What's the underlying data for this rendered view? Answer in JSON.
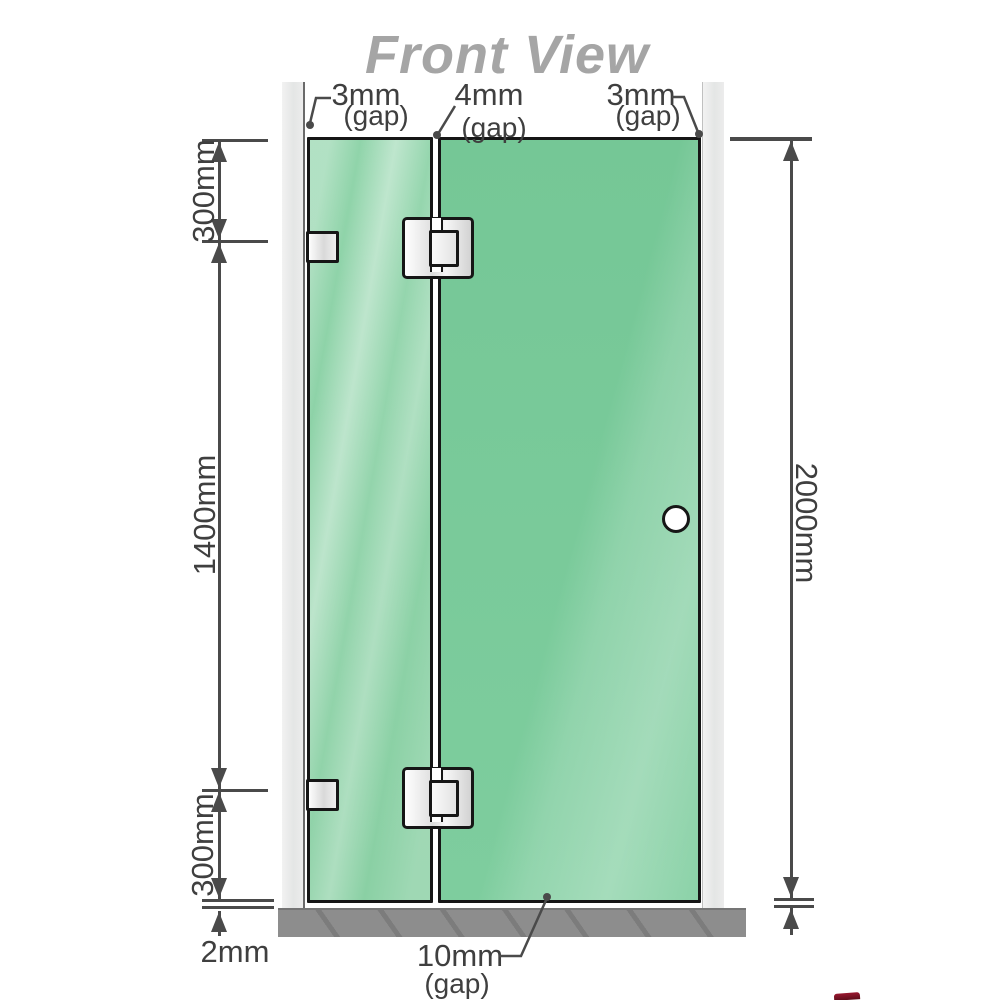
{
  "title": "Front View",
  "gap_labels": {
    "top_left": {
      "value": "3mm",
      "unit": "(gap)"
    },
    "top_middle": {
      "value": "4mm",
      "unit": "(gap)"
    },
    "top_right": {
      "value": "3mm",
      "unit": "(gap)"
    },
    "bottom": {
      "value": "10mm",
      "unit": "(gap)"
    }
  },
  "dimensions": {
    "left_top": "300mm",
    "left_middle": "1400mm",
    "left_bottom": "300mm",
    "base_gap": "2mm",
    "right_overall": "2000mm"
  },
  "colors": {
    "glass_green": "#7cc897",
    "glass_highlight": "#b7e7ca",
    "wall_channel_gray": "#e8e8e8",
    "floor_gray": "#8d8d8d",
    "dimension_gray": "#4a4a4a",
    "label_gray": "#3f3f3f",
    "title_gray": "#a5a5a5",
    "outline_black": "#161616",
    "hardware_white": "#f5f5f5"
  }
}
